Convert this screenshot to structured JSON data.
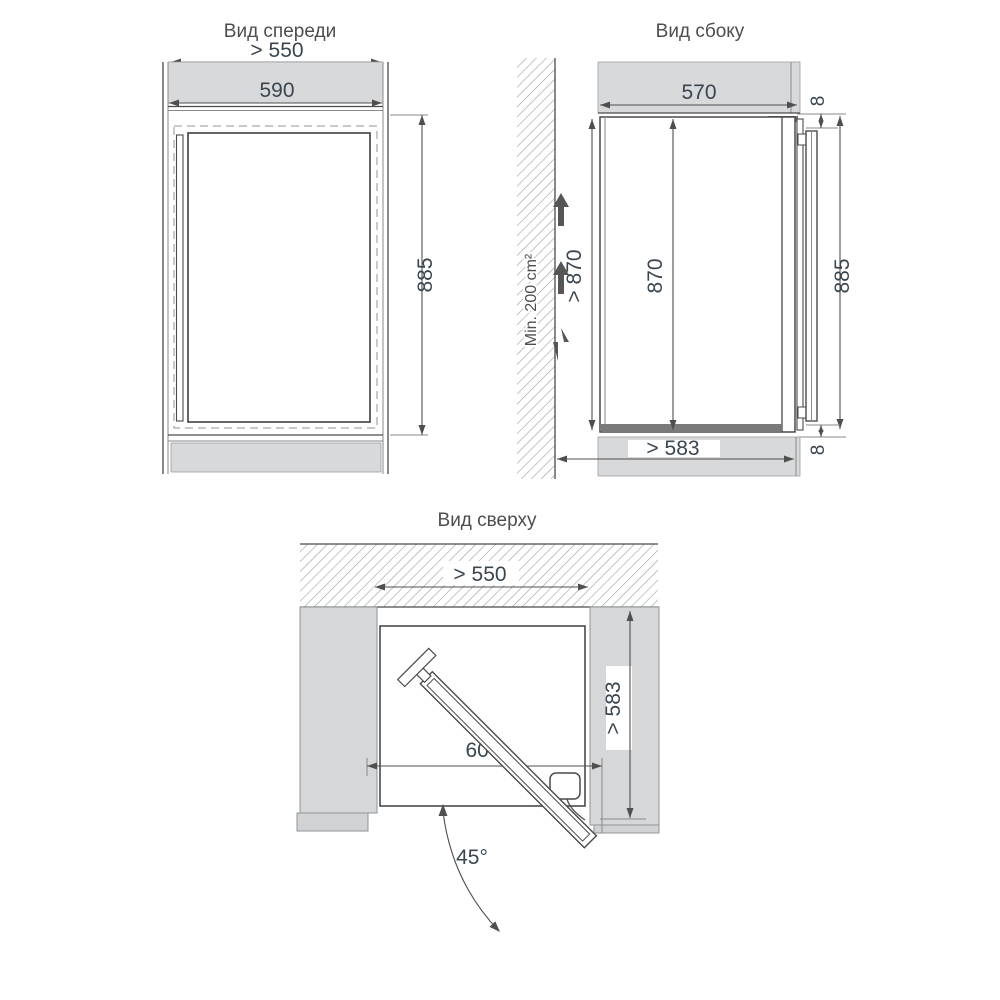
{
  "drawing": {
    "front": {
      "title": "Вид спереди",
      "niche_width": "> 550",
      "width": "590",
      "height": "885"
    },
    "side": {
      "title": "Вид сбоку",
      "depth": "570",
      "top_gap": "8",
      "ventilation": "Min. 200 cm²",
      "niche_height": "> 870",
      "body_height": "870",
      "overall_height": "885",
      "bottom_gap": "8",
      "base_depth": "> 583"
    },
    "top": {
      "title": "Вид сверху",
      "niche_width": "> 550",
      "door_width": "600",
      "niche_depth": "> 583",
      "door_angle": "45°"
    }
  },
  "colors": {
    "line": "#4a4a4a",
    "panel_gray": "#d8d9da",
    "dim_text": "#3a4550",
    "title_text": "#4d4d4d"
  }
}
